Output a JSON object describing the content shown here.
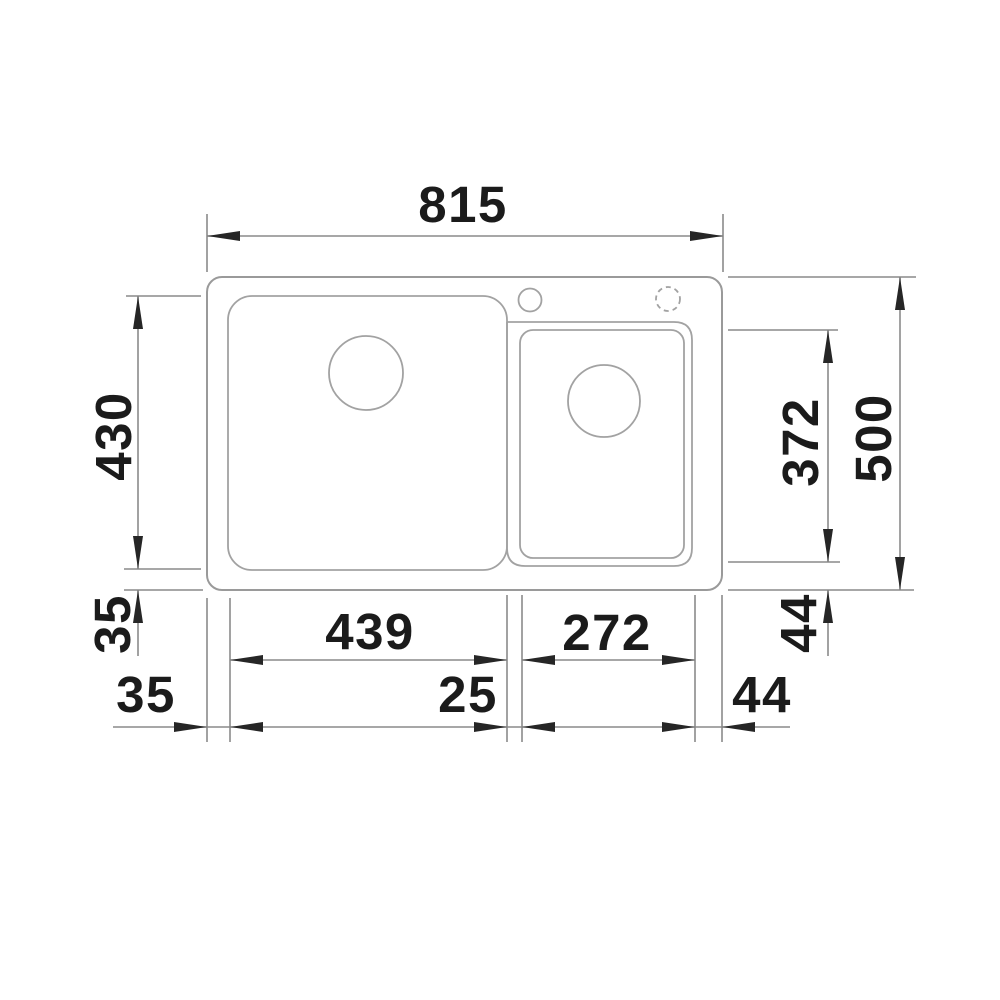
{
  "drawing": {
    "subject": "inset double-bowl kitchen sink, top view technical drawing",
    "units": "mm",
    "colors": {
      "background": "#ffffff",
      "outline": "#9a9a9a",
      "dimension_line": "#8a8a8a",
      "arrow": "#262626",
      "text": "#1b1b1b"
    }
  },
  "dims": {
    "overall_width": "815",
    "overall_depth": "500",
    "main_bowl_depth": "430",
    "main_bowl_width": "439",
    "second_bowl_width": "272",
    "second_bowl_depth": "372",
    "gap_main_bowl_bottom": "35",
    "gap_main_bowl_left": "35",
    "gap_between_bowls": "25",
    "gap_second_bowl_bottom": "44",
    "gap_second_bowl_right": "44"
  }
}
